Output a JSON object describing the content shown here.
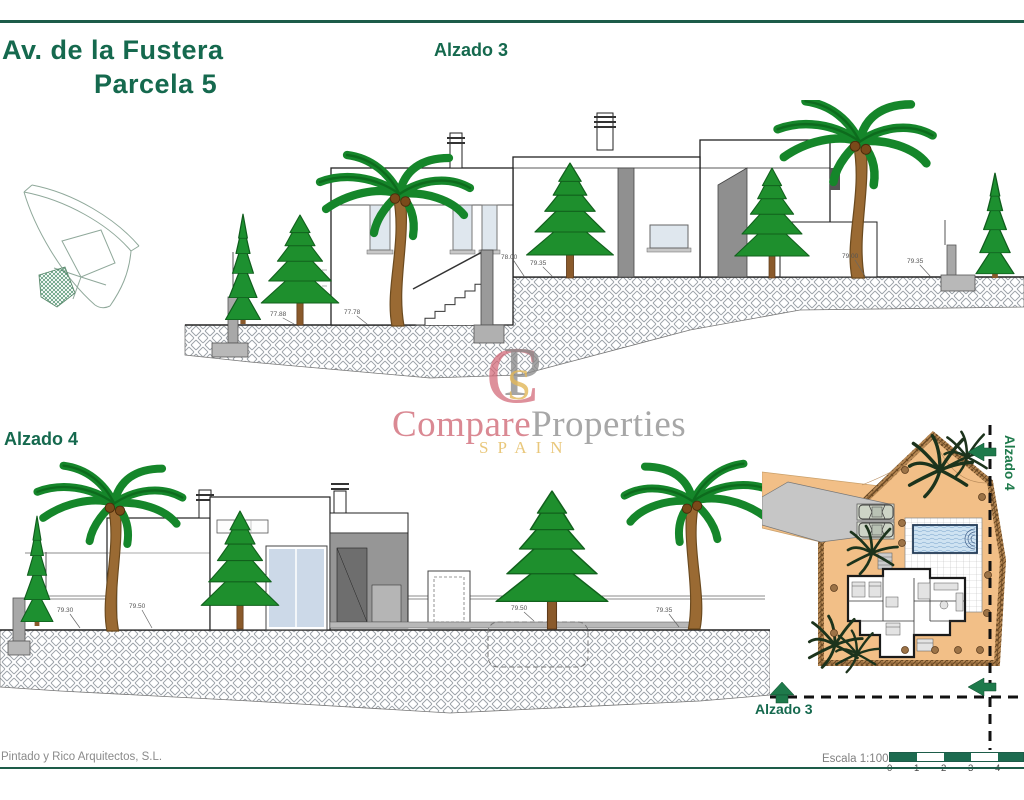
{
  "header": {
    "title_line1": "Av. de la Fustera",
    "title_line2": "Parcela 5",
    "elevation3_label": "Alzado 3",
    "elevation4_label": "Alzado 4"
  },
  "watermark": {
    "monogram_c": "C",
    "monogram_p": "P",
    "monogram_s": "S",
    "word_compare": "Compare",
    "word_properties": "Properties",
    "word_spain": "SPAIN"
  },
  "siteplan": {
    "alzado3_label": "Alzado 3",
    "alzado4_label": "Alzado 4"
  },
  "footer": {
    "architect": "Pintado y Rico Arquitectos, S.L.",
    "scale_label": "Escala 1:100",
    "scale_ticks": [
      "0",
      "1",
      "2",
      "3",
      "4"
    ]
  },
  "dimensions": {
    "elevation3": [
      "77.88",
      "77.78",
      "78.00",
      "79.35",
      "79.00",
      "79.35"
    ],
    "elevation4": [
      "79.30",
      "79.50",
      "79.50",
      "79.35"
    ]
  },
  "colors": {
    "heading_green": "#15694e",
    "rule_green": "#1d5c49",
    "arrow_green": "#1e7a4b",
    "logo_rose": "#d0697f",
    "logo_gray": "#8f8f8f",
    "logo_gold": "#e2b85a",
    "plot_orange": "#f2bf87",
    "pool_blue": "#cfe3f2"
  }
}
